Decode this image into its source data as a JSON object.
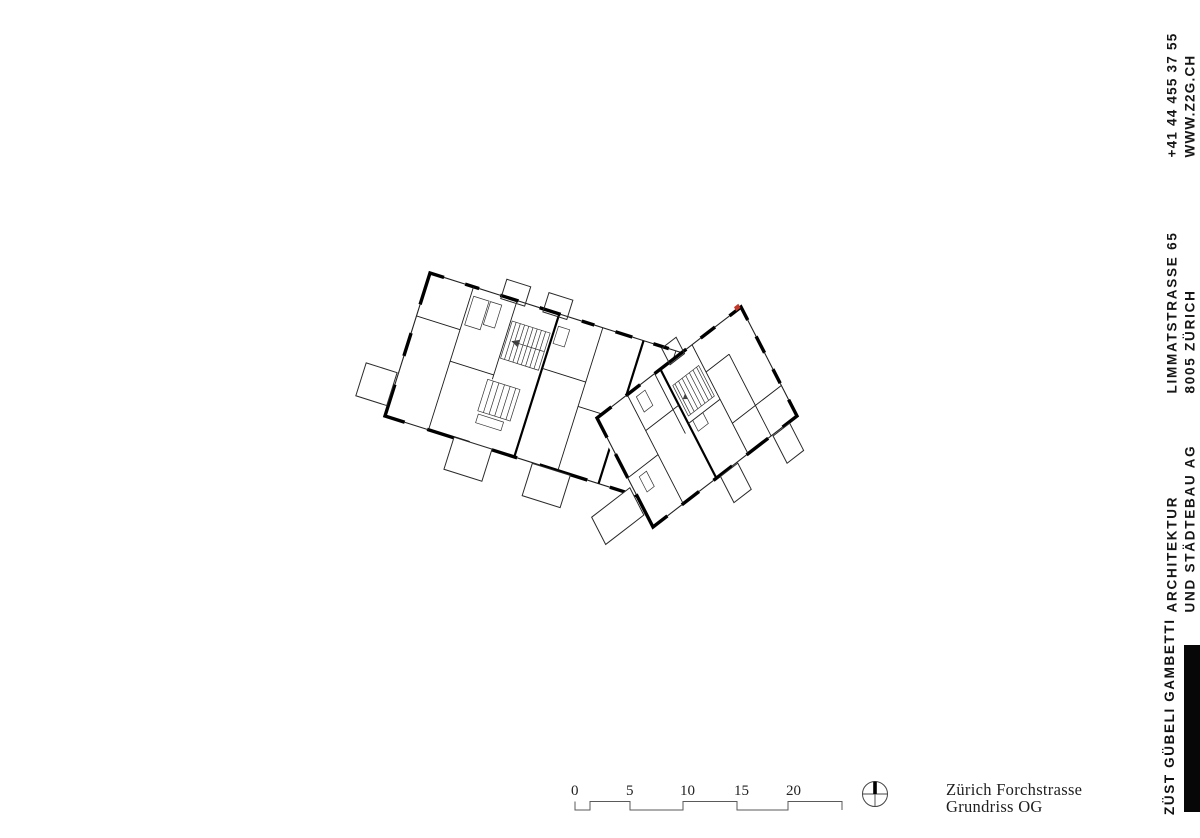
{
  "right_rail": {
    "contact": {
      "line1": "+41 44 455 37 55",
      "line2": "WWW.Z2G.CH"
    },
    "address": {
      "line1": "LIMMATSTRASSE 65",
      "line2": "8005 ZÜRICH"
    },
    "firm": {
      "line1": "ARCHITEKTUR",
      "line2": "UND STÄDTEBAU AG"
    },
    "brand": {
      "name": "ZÜST GÜBELI GAMBETTI"
    }
  },
  "title_block": {
    "project": "Zürich Forchstrasse",
    "sheet": "Grundriss OG"
  },
  "scale_bar": {
    "labels": [
      "0",
      "5",
      "10",
      "15",
      "20"
    ]
  },
  "colors": {
    "background": "#ffffff",
    "ink": "#161616",
    "wall": "#000000",
    "brand_bar": "#070707",
    "accent_red": "#c0392b"
  }
}
